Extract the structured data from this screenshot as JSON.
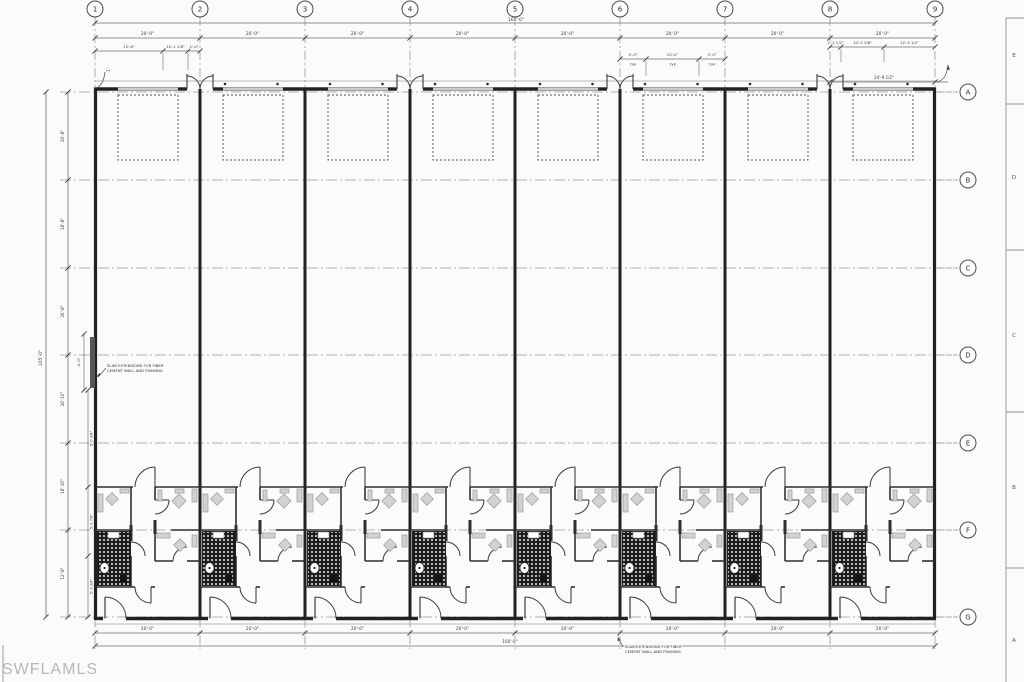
{
  "watermark": "SWFLAMLS",
  "colors": {
    "line": "#3a3a3a",
    "thin": "#6f6f6f",
    "grid_dash": "#9b9b9b",
    "furniture_fill": "#d2d2d2",
    "furniture_stroke": "#9a9a9a",
    "hatch": "#1d1d1d",
    "sheet_bg": "#fbfbf9",
    "watermark_color": "#b7b7b7"
  },
  "grid": {
    "columns": [
      "1",
      "2",
      "3",
      "4",
      "5",
      "6",
      "7",
      "8",
      "9"
    ],
    "rows": [
      "A",
      "B",
      "C",
      "D",
      "E",
      "F",
      "G"
    ]
  },
  "sheet_zones": [
    "E",
    "D",
    "C",
    "B",
    "A"
  ],
  "dimensions": {
    "top_total": "160'-0\"",
    "top_bays": [
      "20'-0\"",
      "20'-0\"",
      "20'-0\"",
      "20'-0\"",
      "20'-0\"",
      "20'-0\"",
      "20'-0\"",
      "20'-0\""
    ],
    "bay1_subs": [
      "12'-8\"",
      "10'-1 1/8\"",
      "2'-0\""
    ],
    "typ_subs": [
      {
        "value": "5'-0\"",
        "tag": "TYP"
      },
      {
        "value": "10'-0\"",
        "tag": "TYP"
      },
      {
        "value": "5'-0\"",
        "tag": "TYP"
      }
    ],
    "bay8_subs": [
      "2'-1 1/2\"",
      "10'-2 3/8\"",
      "12'-4 1/2\""
    ],
    "right_span": "24'-9 1/2\"",
    "corner_offset": "1'",
    "left_chain": [
      "26'-8\"",
      "18'-8\"",
      "26'-8\"",
      "26'-10\"",
      "18'-10\"",
      "12'-8\""
    ],
    "left_total": "105'-0\"",
    "slab_width": "4'-0\"",
    "left_subs": [
      "8'-0 3/4\"",
      "5'-1 7/8\"",
      "5'-3 3/4\""
    ],
    "bottom_bays": [
      "20'-0\"",
      "20'-0\"",
      "20'-0\"",
      "20'-0\"",
      "20'-0\"",
      "20'-0\"",
      "20'-0\"",
      "20'-0\""
    ],
    "bottom_total": "160'-0\""
  },
  "notes": {
    "slab_left_line1": "SLAB EXTENSIONS FOR FIBER",
    "slab_left_line2": "CEMENT WALL AND FRAMING",
    "slab_bottom_line1": "SLAB EXTENSIONS FOR FIBER",
    "slab_bottom_line2": "CEMENT WALL AND FRAMING"
  }
}
